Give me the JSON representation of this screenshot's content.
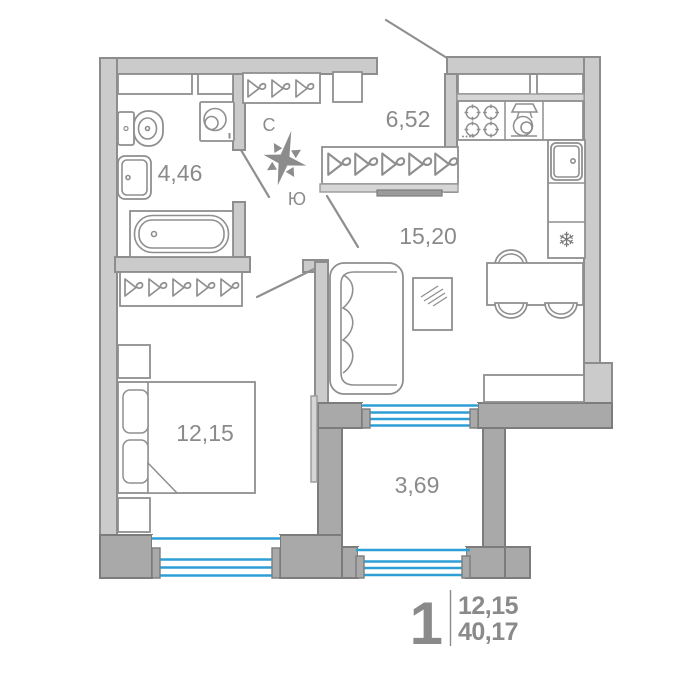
{
  "rooms": {
    "hall": {
      "label": "6,52"
    },
    "bathroom": {
      "label": "4,46"
    },
    "kitchen_living": {
      "label": "15,20"
    },
    "bedroom": {
      "label": "12,15"
    },
    "balcony": {
      "label": "3,69"
    }
  },
  "compass": {
    "north": "С",
    "south": "Ю"
  },
  "legend": {
    "room_count": "1",
    "living_area": "12,15",
    "total_area": "40,17"
  },
  "icons": {
    "fridge_snowflake": "❄"
  },
  "colors": {
    "wall_light": "#cbcbcb",
    "wall_dark": "#a9a9a9",
    "wall_outline": "#8d8d8d",
    "furniture_line": "#8f8f8f",
    "window_glass": "#2e9fd6",
    "label_text": "#8a8a8a"
  }
}
